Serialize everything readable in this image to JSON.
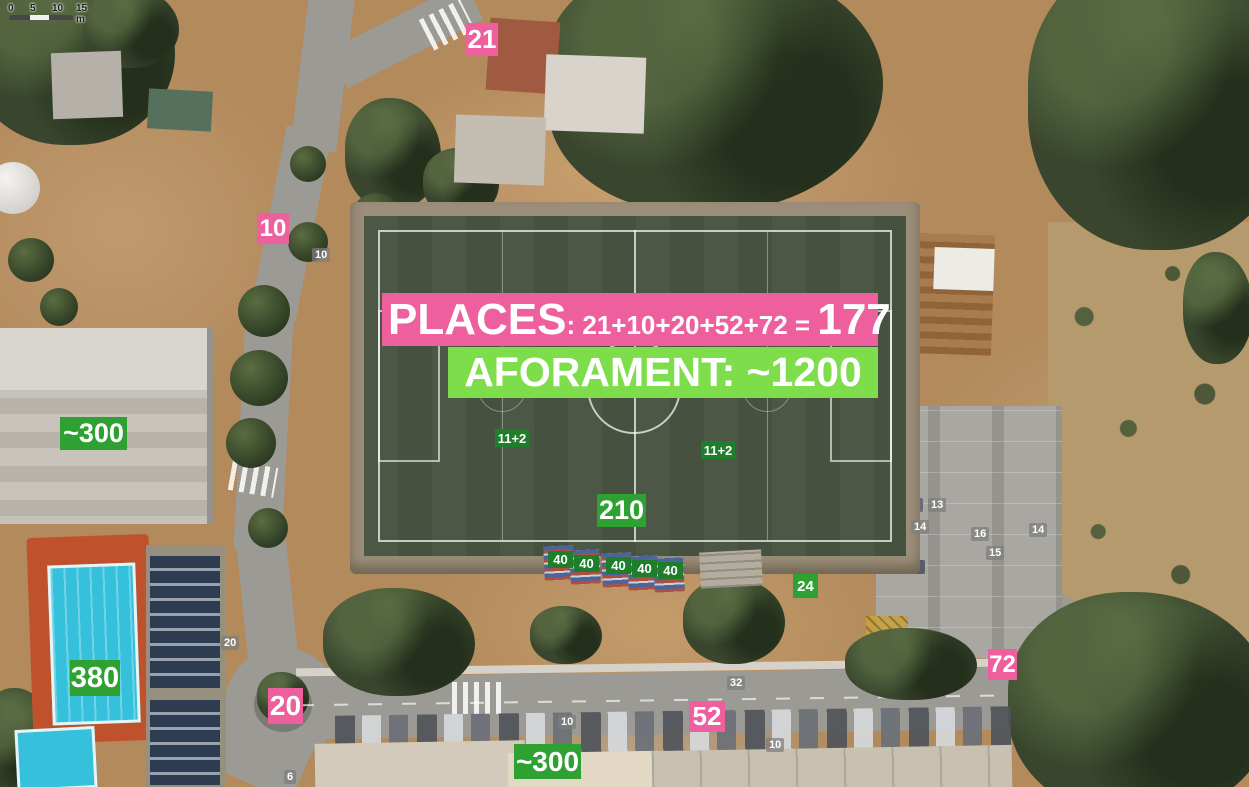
{
  "map": {
    "scale_bar": {
      "ticks": [
        "0",
        "5",
        "10",
        "15 m"
      ]
    },
    "street_labels": [
      {
        "text": "10"
      },
      {
        "text": "20"
      },
      {
        "text": "32"
      },
      {
        "text": "13"
      },
      {
        "text": "14"
      },
      {
        "text": "16"
      },
      {
        "text": "14"
      },
      {
        "text": "15"
      },
      {
        "text": "10"
      },
      {
        "text": "10"
      },
      {
        "text": "6"
      }
    ]
  },
  "annotations": {
    "colors": {
      "access_pink": "#ee5f9e",
      "capacity_green": "#2fa133",
      "banner_green": "#7edd4b",
      "pitch_green": "#1e7e2b"
    },
    "places_banner": {
      "label": "PLACES",
      "formula": ": 21+10+20+52+72 = ",
      "total": "177"
    },
    "aforament_banner": {
      "text": "AFORAMENT: ~1200"
    },
    "access_counts": [
      {
        "text": "21"
      },
      {
        "text": "10"
      },
      {
        "text": "20"
      },
      {
        "text": "52"
      },
      {
        "text": "72"
      }
    ],
    "capacity_counts": [
      {
        "text": "~300"
      },
      {
        "text": "380"
      },
      {
        "text": "210"
      },
      {
        "text": "~300"
      },
      {
        "text": "24"
      }
    ],
    "pitch_labels": [
      {
        "text": "11+2"
      },
      {
        "text": "11+2"
      }
    ],
    "stand_sections": [
      {
        "text": "40"
      },
      {
        "text": "40"
      },
      {
        "text": "40"
      },
      {
        "text": "40"
      },
      {
        "text": "40"
      }
    ]
  }
}
